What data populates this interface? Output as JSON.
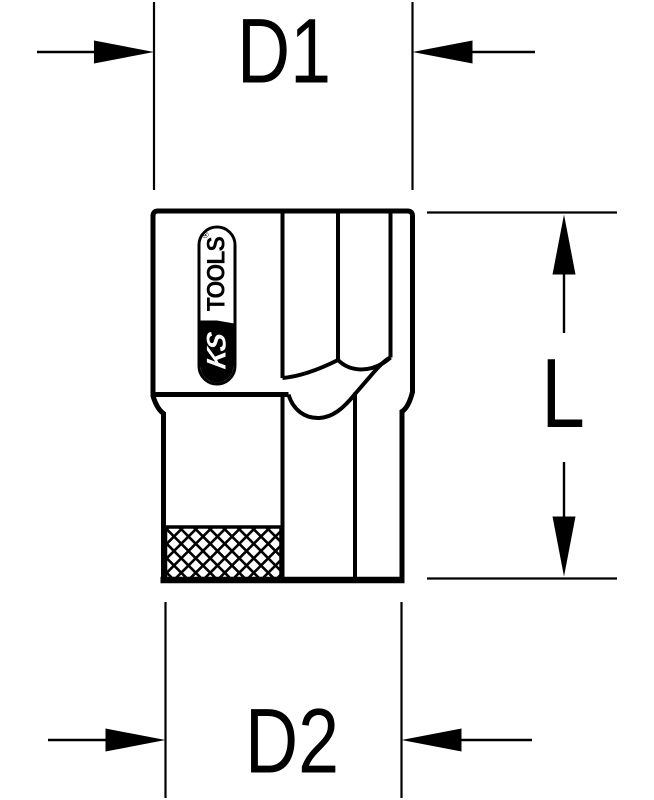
{
  "page": {
    "background": "#ffffff",
    "line_color": "#000000",
    "description": "Technical dimensional drawing of a socket wrench bit"
  },
  "labels": {
    "top_width": "D1",
    "length": "L",
    "bottom_width": "D2"
  },
  "logo": {
    "ks": "KS",
    "tools": "TOOLS",
    "registered": "®"
  }
}
